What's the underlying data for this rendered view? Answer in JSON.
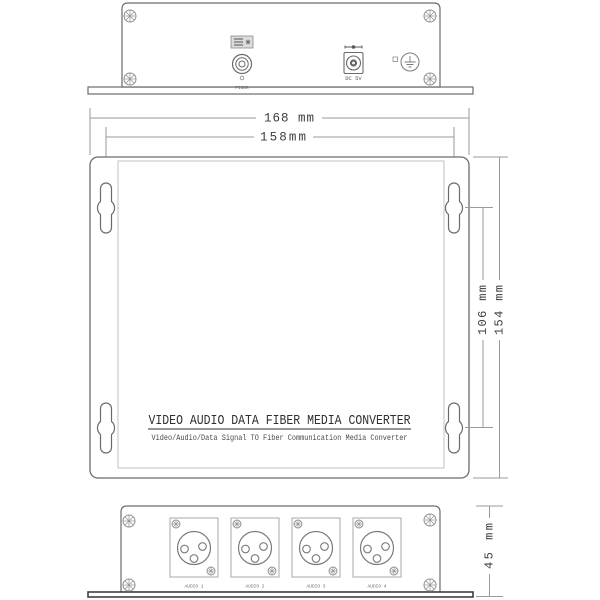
{
  "drawing": {
    "product": {
      "title": "VIDEO AUDIO DATA FIBER MEDIA CONVERTER",
      "subtitle": "Video/Audio/Data Signal TO Fiber Communication Media Converter"
    },
    "dimensions": {
      "overall_width": "168 mm",
      "mounting_hole_spacing_width": "158mm",
      "mounting_hole_spacing_height": "106 mm",
      "overall_height": "154 mm",
      "depth": "45 mm"
    },
    "top_panel": {
      "fiber_port_label": "FIBER",
      "power_port_label": "DC 5V"
    },
    "bottom_panel": {
      "ports": [
        {
          "label": "AUDIO 1"
        },
        {
          "label": "AUDIO 2"
        },
        {
          "label": "AUDIO 3"
        },
        {
          "label": "AUDIO 4"
        }
      ]
    },
    "colors": {
      "outline": "#6b6b6b",
      "dimension_line": "#9a9a9a",
      "text": "#3b3b3b",
      "flange_edge": "#3f3f3f",
      "background": "#ffffff"
    }
  }
}
